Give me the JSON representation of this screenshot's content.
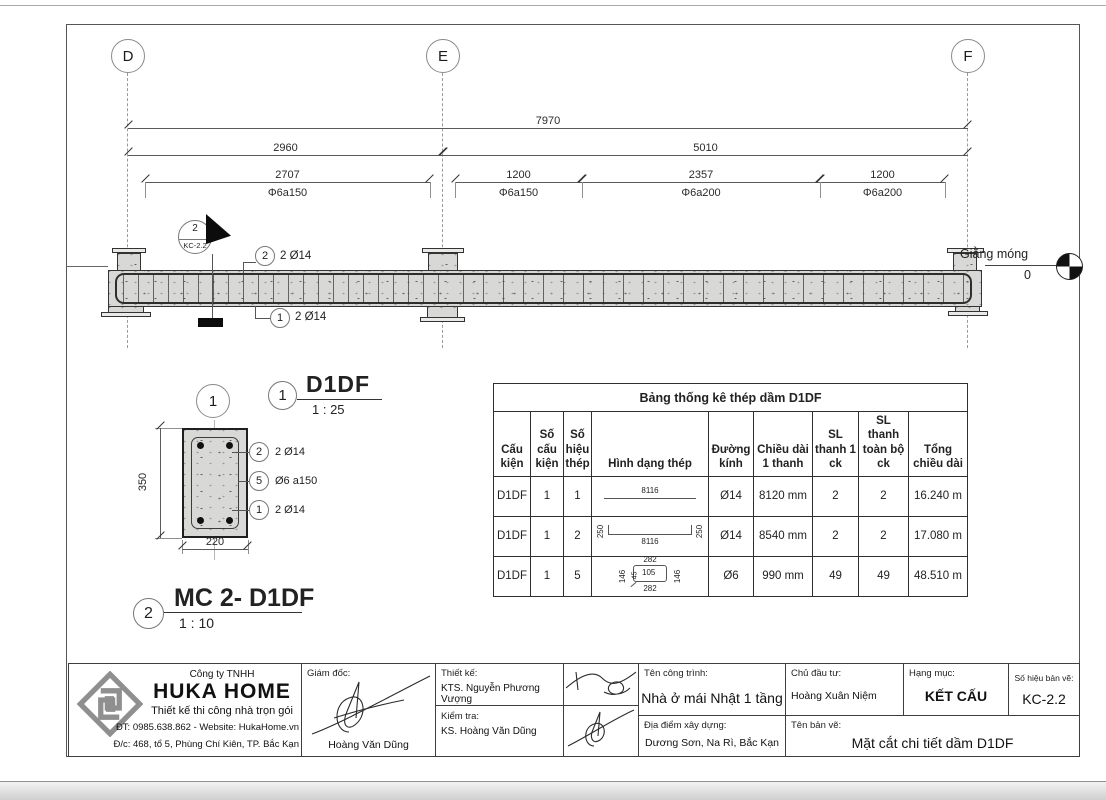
{
  "grid": {
    "d": "D",
    "e": "E",
    "f": "F"
  },
  "dims": {
    "total": "7970",
    "span_de": "2960",
    "span_ef": "5010",
    "segments": [
      {
        "len": "2707",
        "rebar": "Φ6a150"
      },
      {
        "len": "1200",
        "rebar": "Φ6a150"
      },
      {
        "len": "2357",
        "rebar": "Φ6a200"
      },
      {
        "len": "1200",
        "rebar": "Φ6a200"
      }
    ]
  },
  "elevation": {
    "section_marker": {
      "number": "2",
      "sheet": "KC-2.2"
    },
    "callout_top": {
      "number": "2",
      "label": "2 Ø14"
    },
    "callout_bottom": {
      "number": "1",
      "label": "2 Ø14"
    },
    "level": {
      "label": "Giằng móng",
      "value": "0"
    }
  },
  "section": {
    "grid_bubble": "1",
    "dim_height": "350",
    "dim_width": "220",
    "callouts": [
      {
        "number": "2",
        "label": "2 Ø14"
      },
      {
        "number": "5",
        "label": "Ø6 a150"
      },
      {
        "number": "1",
        "label": "2 Ø14"
      }
    ],
    "title1": {
      "number": "1",
      "name": "D1DF",
      "scale": "1 : 25"
    },
    "title2": {
      "number": "2",
      "name": "MC 2- D1DF",
      "scale": "1 : 10"
    }
  },
  "table": {
    "title": "Bảng thống kê thép dầm D1DF",
    "headers": [
      "Cấu kiện",
      "Số cấu kiện",
      "Số hiệu thép",
      "Hình dạng thép",
      "Đường kính",
      "Chiều dài 1 thanh",
      "SL thanh 1 ck",
      "SL thanh toàn bộ ck",
      "Tổng chiều dài"
    ],
    "rows": [
      {
        "cau_kien": "D1DF",
        "so_cau_kien": "1",
        "so_hieu": "1",
        "shape_top": "8116",
        "duong_kinh": "Ø14",
        "chieu_dai": "8120 mm",
        "sl1": "2",
        "sl2": "2",
        "tong": "16.240 m"
      },
      {
        "cau_kien": "D1DF",
        "so_cau_kien": "1",
        "so_hieu": "2",
        "shape_end_left": "250",
        "shape_end_right": "250",
        "shape_bottom": "8116",
        "duong_kinh": "Ø14",
        "chieu_dai": "8540 mm",
        "sl1": "2",
        "sl2": "2",
        "tong": "17.080 m"
      },
      {
        "cau_kien": "D1DF",
        "so_cau_kien": "1",
        "so_hieu": "5",
        "shape_top": "282",
        "shape_bottom": "282",
        "shape_left": "146",
        "shape_right": "146",
        "shape_inner": "105",
        "shape_hook": "45",
        "duong_kinh": "Ø6",
        "chieu_dai": "990 mm",
        "sl1": "49",
        "sl2": "49",
        "tong": "48.510 m"
      }
    ]
  },
  "titleblock": {
    "company": {
      "line1": "Công ty TNHH",
      "name": "HUKA HOME",
      "tagline": "Thiết kế thi công nhà trọn gói",
      "phone": "ĐT: 0985.638.862 - Website: HukaHome.vn",
      "address": "Đ/c: 468, tổ 5, Phùng Chí Kiên, TP. Bắc Kạn"
    },
    "director": {
      "label": "Giám đốc:",
      "name": "Hoàng Văn Dũng"
    },
    "designer": {
      "label": "Thiết kế:",
      "name": "KTS. Nguyễn Phương Vượng"
    },
    "checker": {
      "label": "Kiểm tra:",
      "name": "KS. Hoàng Văn Dũng"
    },
    "project": {
      "label": "Tên công trình:",
      "name": "Nhà ở mái Nhật 1 tầng"
    },
    "location": {
      "label": "Địa điểm xây dựng:",
      "name": "Dương Sơn, Na Rì, Bắc Kạn"
    },
    "investor": {
      "label": "Chủ đầu tư:",
      "name": "Hoàng Xuân Niệm"
    },
    "category": {
      "label": "Hạng mục:",
      "name": "KẾT CẤU"
    },
    "drawing_no": {
      "label": "Số hiệu bản vẽ:",
      "value": "KC-2.2"
    },
    "drawing_name": {
      "label": "Tên bản vẽ:",
      "value": "Mặt cắt chi tiết dầm D1DF"
    }
  }
}
